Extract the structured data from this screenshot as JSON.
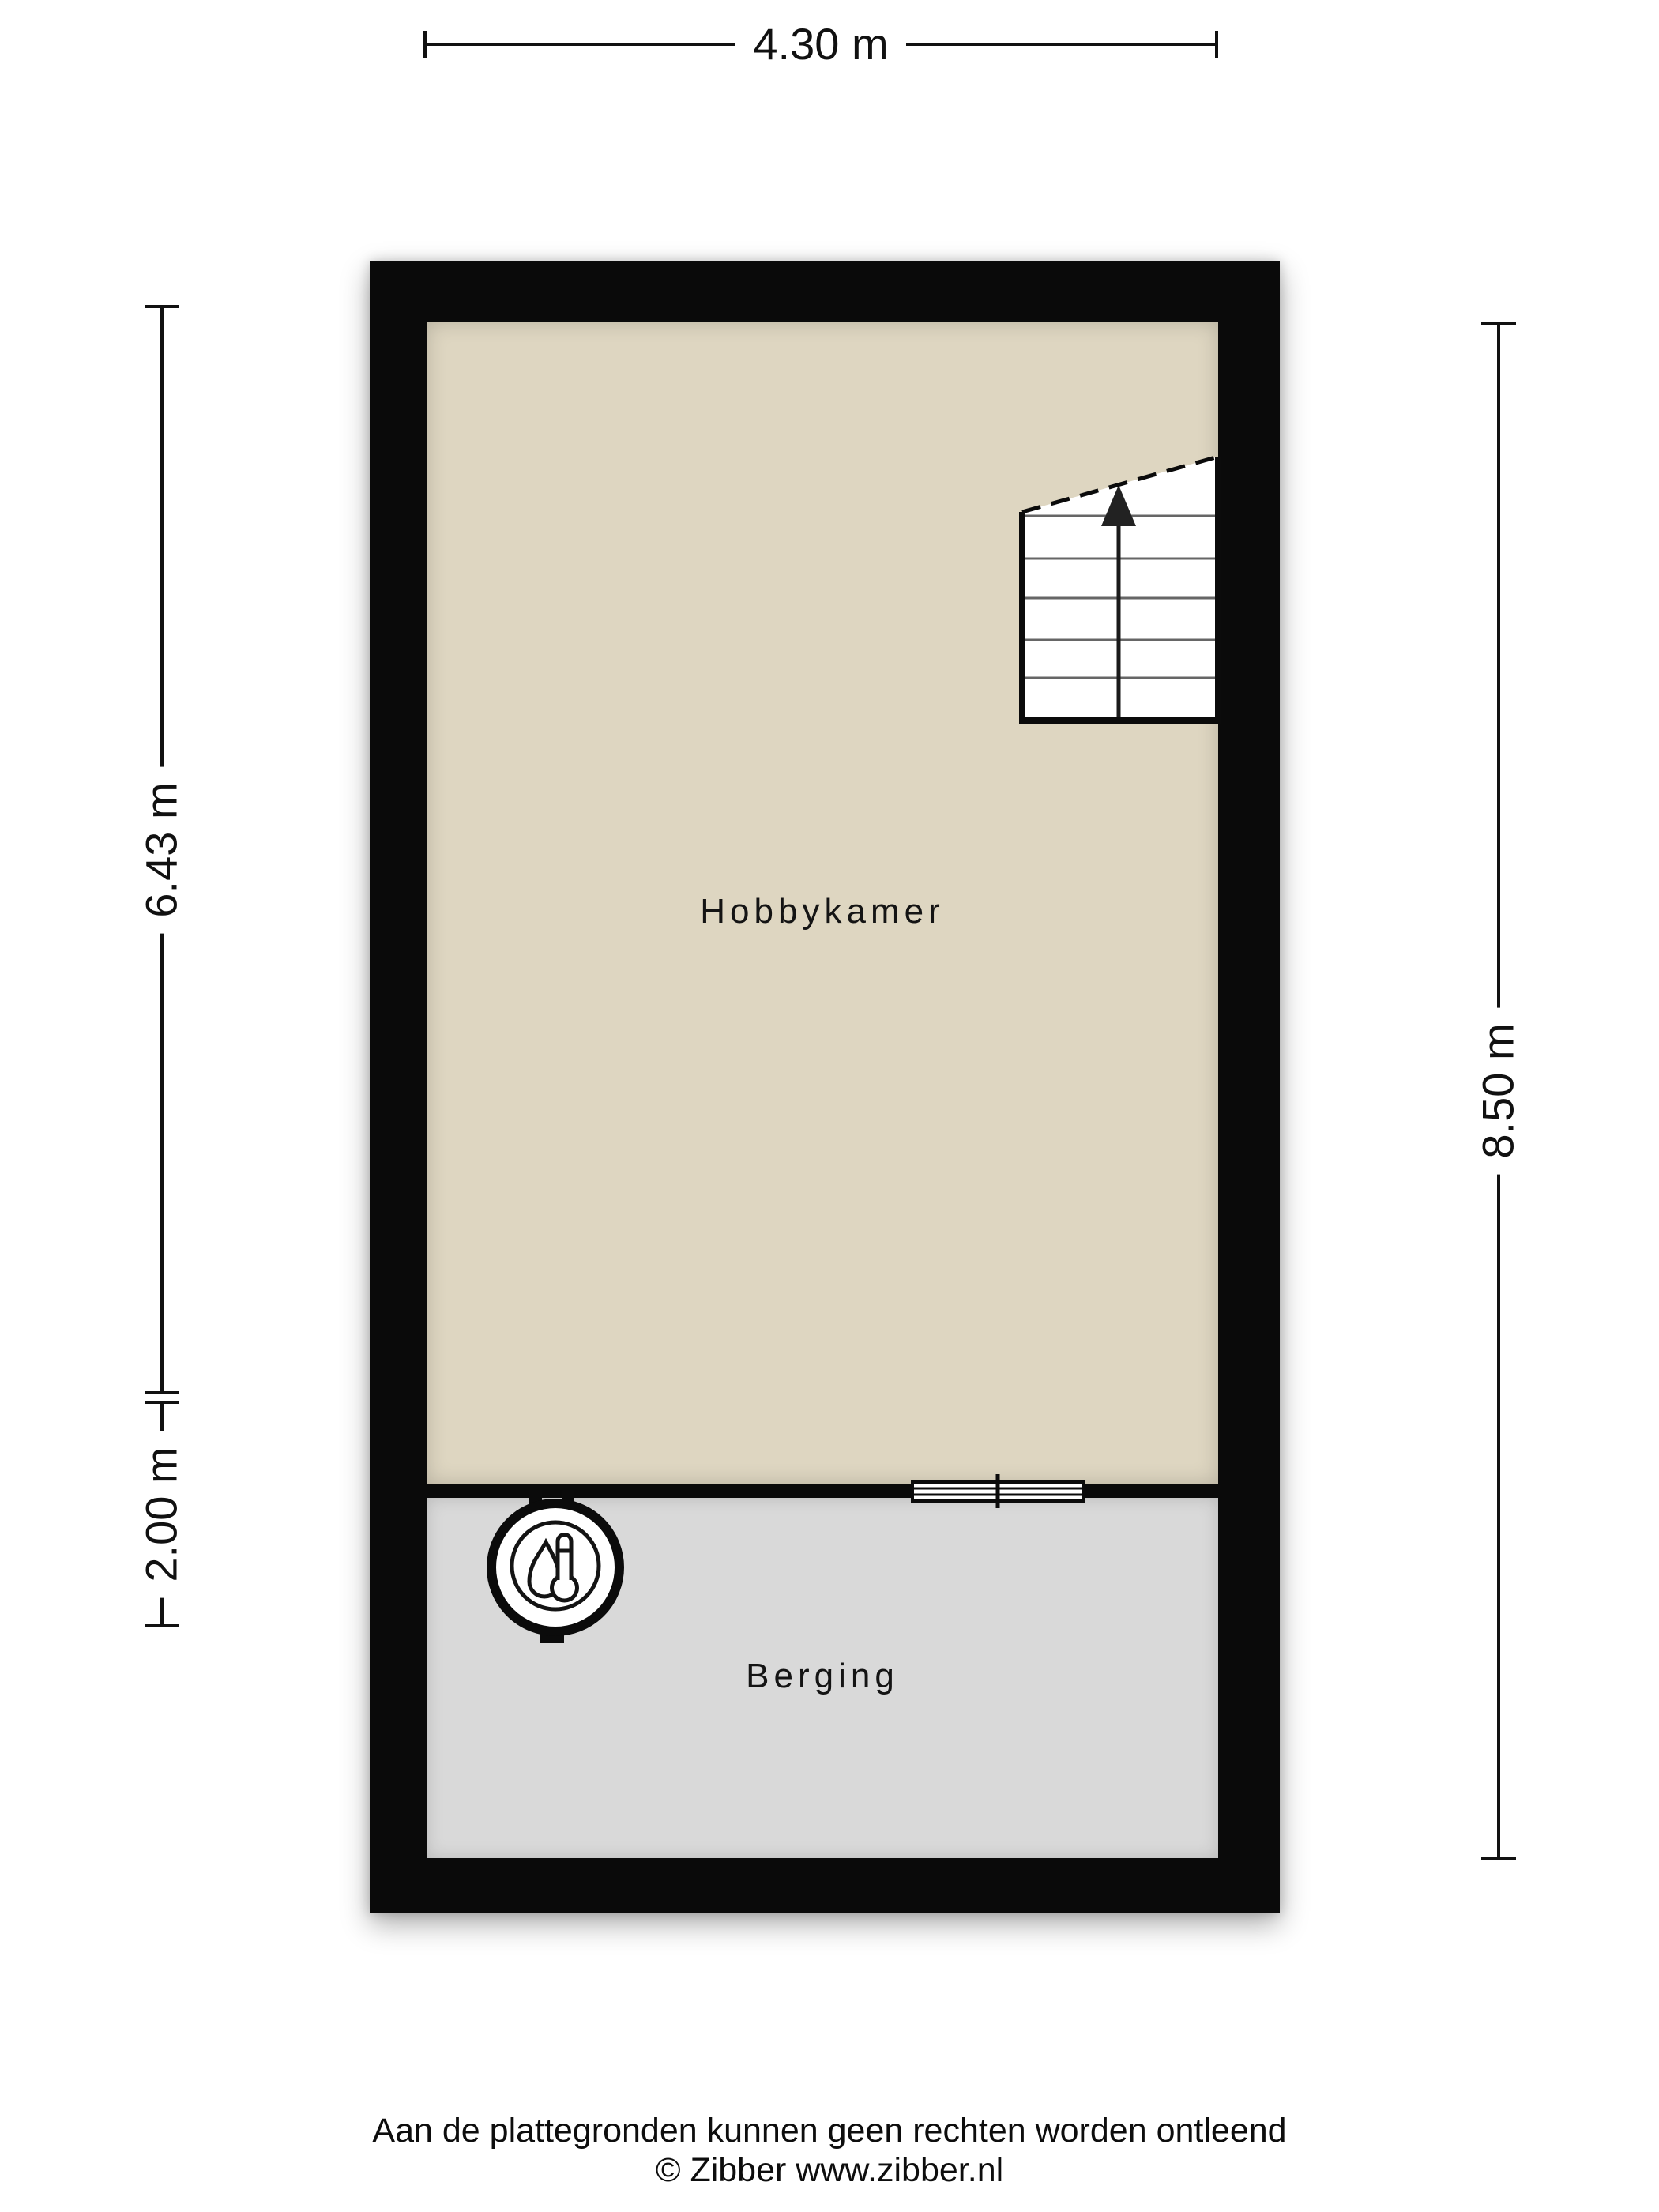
{
  "dimensions": {
    "top": {
      "label": "4.30 m"
    },
    "left_upper": {
      "label": "6.43 m"
    },
    "left_lower": {
      "label": "2.00 m"
    },
    "right": {
      "label": "8.50 m"
    }
  },
  "rooms": {
    "hobbykamer": {
      "label": "Hobbykamer"
    },
    "berging": {
      "label": "Berging"
    }
  },
  "icons": {
    "boiler": "boiler-thermometer-droplet-icon",
    "stairs": "staircase-up-arrow-icon",
    "window": "window-symbol"
  },
  "footer": {
    "disclaimer": "Aan de plattegronden kunnen geen rechten worden ontleend",
    "copyright": "© Zibber www.zibber.nl"
  },
  "colors": {
    "background": "#ffffff",
    "wall": "#0a0a0a",
    "hobbykamer_floor": "#ded6c1",
    "berging_floor": "#d9d9d9",
    "text": "#111111",
    "stair_tread": "#666666"
  }
}
